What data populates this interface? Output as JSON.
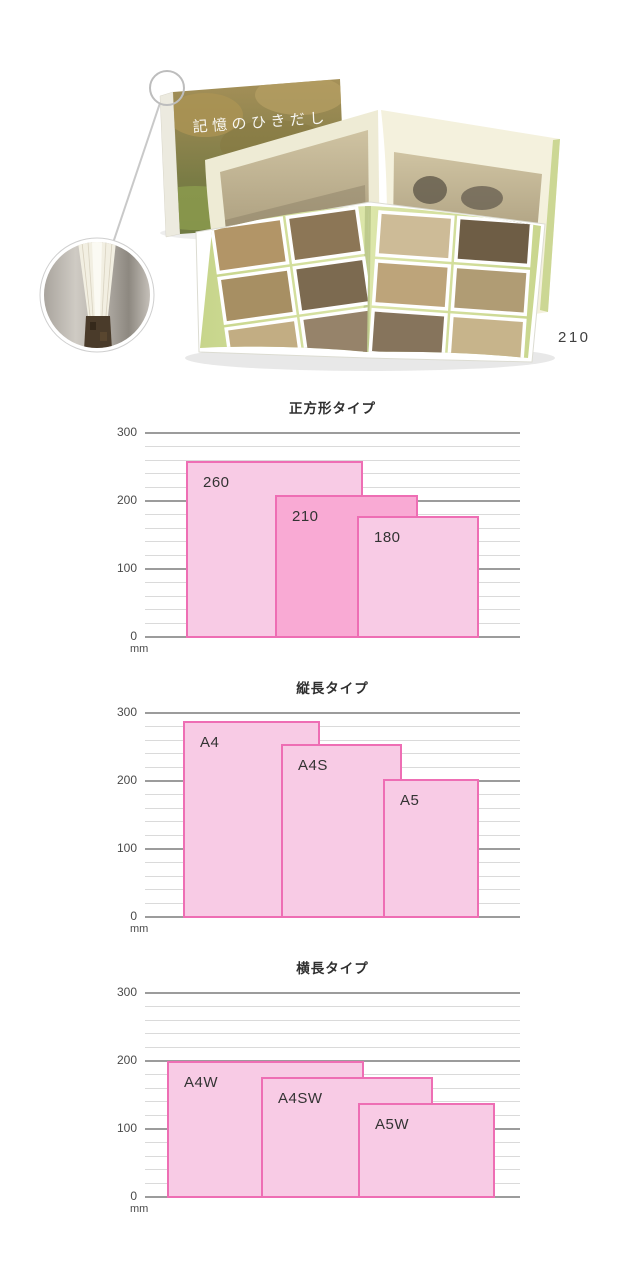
{
  "page": {
    "background": "#ffffff"
  },
  "hero": {
    "cover_title": "記憶のひきだし",
    "size_label": "210"
  },
  "colors": {
    "bar_fill": "#f8cbe5",
    "bar_fill_highlight": "#f9aad4",
    "bar_border": "#ee6eb4",
    "grid_major": "#9c9c9c",
    "grid_minor": "#dadada",
    "bar_label_text": "#333333",
    "axis_text": "#4a4a4a"
  },
  "chart_data": [
    {
      "type": "bar",
      "title": "正方形タイプ",
      "ylabel": "mm",
      "unit": "mm",
      "ylim": [
        0,
        300
      ],
      "y_ticks": [
        0,
        100,
        200,
        300
      ],
      "minor_grid_step_mm": 20,
      "grid": true,
      "legend": "none",
      "bars": [
        {
          "label": "260",
          "height_mm": 260,
          "width_mm": 260,
          "offset_px": 41,
          "highlight": false
        },
        {
          "label": "210",
          "height_mm": 210,
          "width_mm": 210,
          "offset_px": 130,
          "highlight": true
        },
        {
          "label": "180",
          "height_mm": 180,
          "width_mm": 180,
          "offset_px": 212,
          "highlight": false
        }
      ]
    },
    {
      "type": "bar",
      "title": "縦長タイプ",
      "ylabel": "mm",
      "unit": "mm",
      "ylim": [
        0,
        300
      ],
      "y_ticks": [
        0,
        100,
        200,
        300
      ],
      "minor_grid_step_mm": 20,
      "grid": true,
      "legend": "none",
      "bars": [
        {
          "label": "A4",
          "height_mm": 290,
          "width_mm": 202,
          "offset_px": 38,
          "highlight": false
        },
        {
          "label": "A4S",
          "height_mm": 256,
          "width_mm": 178,
          "offset_px": 136,
          "highlight": false
        },
        {
          "label": "A5",
          "height_mm": 205,
          "width_mm": 141,
          "offset_px": 238,
          "highlight": false
        }
      ]
    },
    {
      "type": "bar",
      "title": "横長タイプ",
      "ylabel": "mm",
      "unit": "mm",
      "ylim": [
        0,
        300
      ],
      "y_ticks": [
        0,
        100,
        200,
        300
      ],
      "minor_grid_step_mm": 20,
      "grid": true,
      "legend": "none",
      "bars": [
        {
          "label": "A4W",
          "height_mm": 202,
          "width_mm": 290,
          "offset_px": 22,
          "highlight": false
        },
        {
          "label": "A4SW",
          "height_mm": 178,
          "width_mm": 253,
          "offset_px": 116,
          "highlight": false
        },
        {
          "label": "A5W",
          "height_mm": 140,
          "width_mm": 202,
          "offset_px": 213,
          "highlight": false
        }
      ]
    }
  ]
}
